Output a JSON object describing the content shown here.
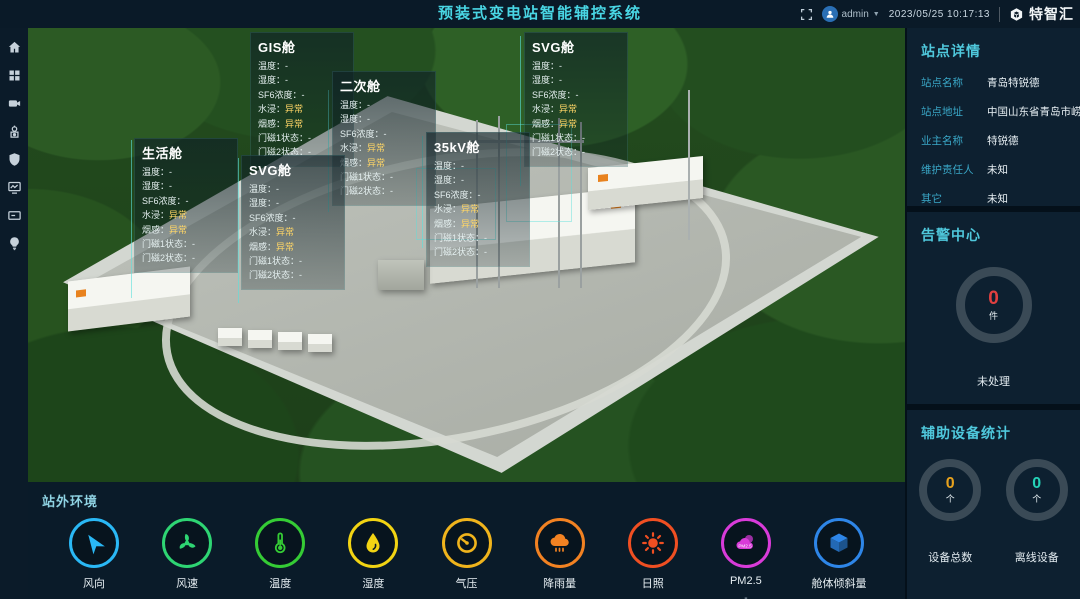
{
  "header": {
    "title": "预装式变电站智能辅控系统",
    "user": "admin",
    "datetime": "2023/05/25 10:17:13",
    "brand": "特智汇"
  },
  "sidebar": {
    "items": [
      {
        "id": "home"
      },
      {
        "id": "apps"
      },
      {
        "id": "video"
      },
      {
        "id": "robot"
      },
      {
        "id": "shield"
      },
      {
        "id": "monitor"
      },
      {
        "id": "panel"
      },
      {
        "id": "bulb"
      }
    ]
  },
  "scene": {
    "panels": [
      {
        "title": "GIS舱"
      },
      {
        "title": "二次舱"
      },
      {
        "title": "SVG舱"
      },
      {
        "title": "35kV舱"
      },
      {
        "title": "生活舱"
      },
      {
        "title": "SVG舱"
      }
    ],
    "panel_rows": [
      {
        "label": "温度",
        "value": "-"
      },
      {
        "label": "湿度",
        "value": "-"
      },
      {
        "label": "SF6浓度",
        "value": "-"
      },
      {
        "label": "水浸",
        "value": "异常"
      },
      {
        "label": "烟感",
        "value": "异常"
      },
      {
        "label": "门磁1状态",
        "value": "-"
      },
      {
        "label": "门磁2状态",
        "value": "-"
      }
    ],
    "abnormal_color": "#ffd666"
  },
  "site_details": {
    "title": "站点详情",
    "fields": [
      {
        "label": "站点名称",
        "value": "青岛特锐德"
      },
      {
        "label": "站点地址",
        "value": "中国山东省青岛市崂山区"
      },
      {
        "label": "业主名称",
        "value": "特锐德"
      },
      {
        "label": "维护责任人",
        "value": "未知"
      },
      {
        "label": "其它",
        "value": "未知"
      }
    ]
  },
  "alarm_center": {
    "title": "告警中心",
    "count": "0",
    "unit": "件",
    "status_label": "未处理",
    "count_color": "#e04040"
  },
  "device_stats": {
    "title": "辅助设备统计",
    "items": [
      {
        "count": "0",
        "unit": "个",
        "label": "设备总数",
        "color": "#e8a21d"
      },
      {
        "count": "0",
        "unit": "个",
        "label": "离线设备",
        "color": "#25d3b8"
      }
    ]
  },
  "environment": {
    "title": "站外环境",
    "items": [
      {
        "id": "wind-direction",
        "label": "风向",
        "value": "-",
        "color": "#2ab8f5"
      },
      {
        "id": "wind-speed",
        "label": "风速",
        "value": "-",
        "color": "#2ed573"
      },
      {
        "id": "temperature",
        "label": "温度",
        "value": "-",
        "color": "#35cc35"
      },
      {
        "id": "humidity",
        "label": "湿度",
        "value": "-",
        "color": "#f2d413"
      },
      {
        "id": "pressure",
        "label": "气压",
        "value": "-",
        "color": "#f0b41c"
      },
      {
        "id": "rainfall",
        "label": "降雨量",
        "value": "-",
        "color": "#f28222"
      },
      {
        "id": "sunshine",
        "label": "日照",
        "value": "-",
        "color": "#f04f22"
      },
      {
        "id": "pm25",
        "label": "PM2.5",
        "value": "-",
        "color": "#d93bd9"
      },
      {
        "id": "tilt",
        "label": "舱体倾斜量",
        "value": "-",
        "color": "#2e86e8"
      }
    ]
  },
  "colors": {
    "accent": "#49d6e4",
    "section_bg": "#0d2030",
    "leader_line": "#5ae1dc"
  }
}
